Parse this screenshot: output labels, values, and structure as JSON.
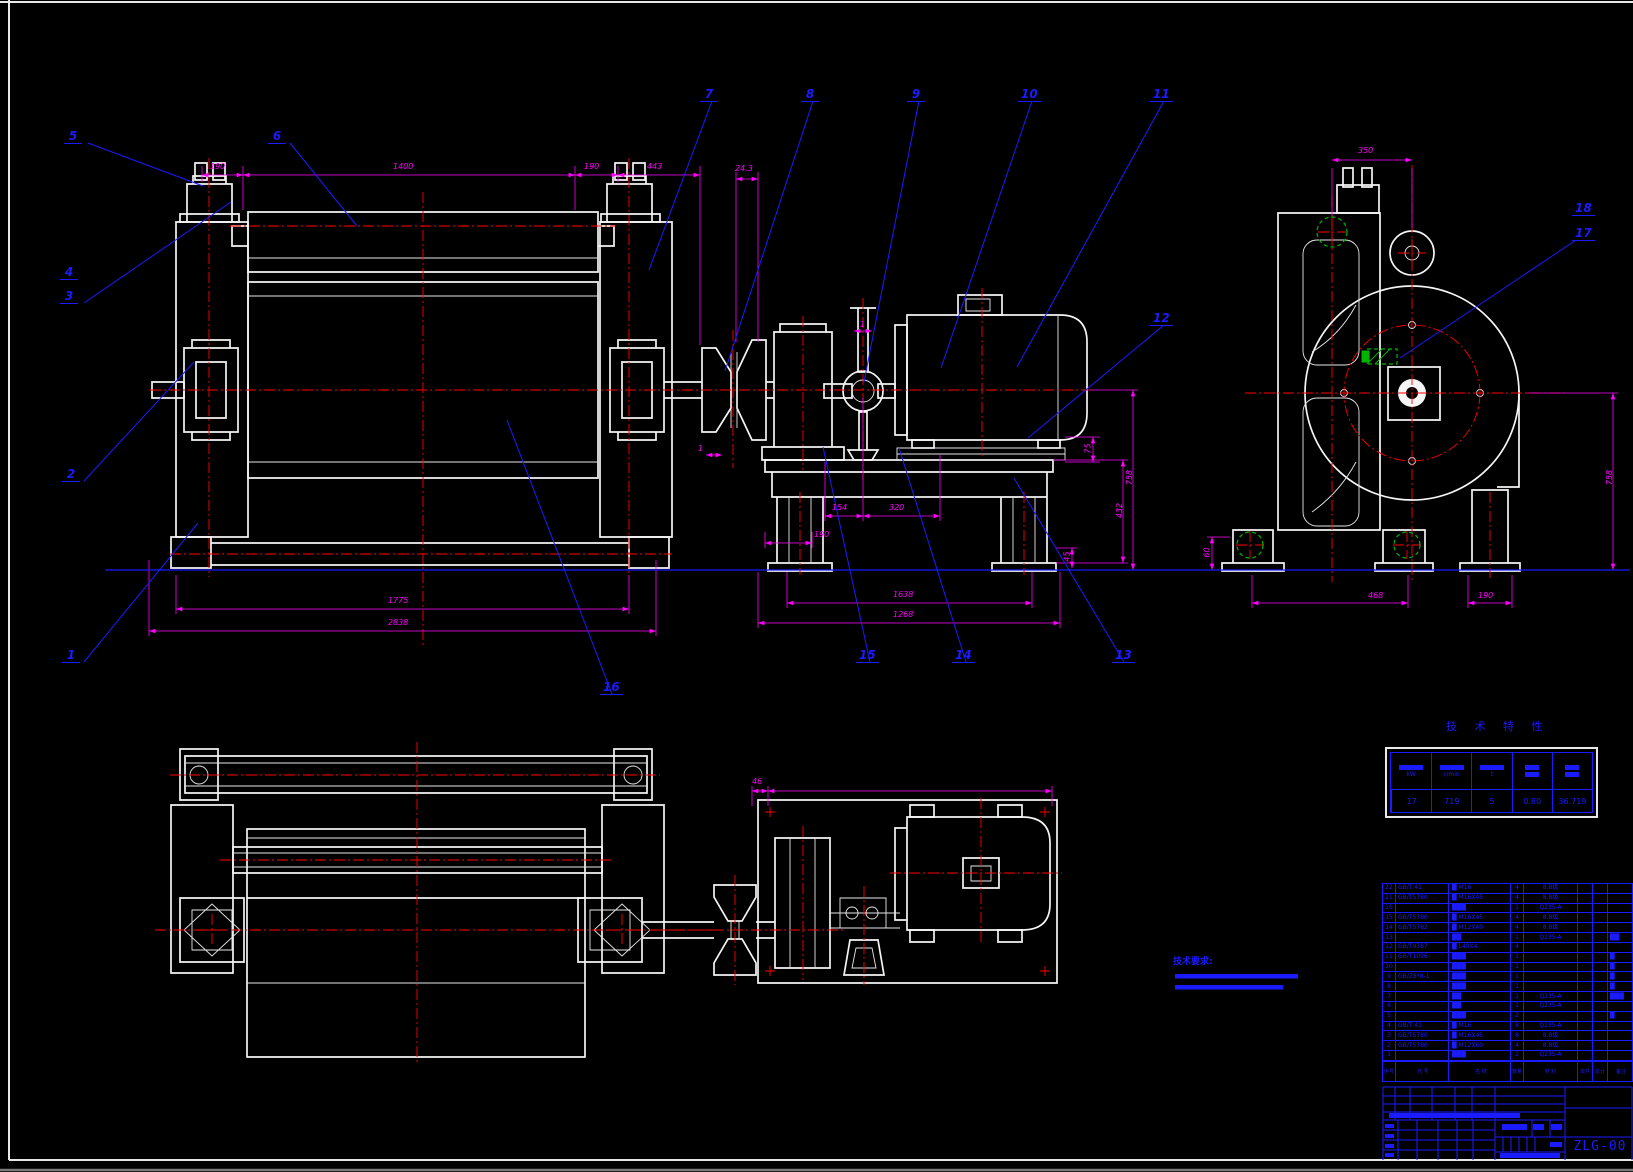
{
  "sheet": {
    "drawing_no": "ZLG-00"
  },
  "tech_note": {
    "label": "技术要求:"
  },
  "tech_table": {
    "title": "技 术 特 性",
    "units": [
      "kW",
      "r/min",
      "t",
      "",
      ""
    ],
    "values": [
      "17",
      "719",
      "5",
      "0.80",
      "36.719"
    ]
  },
  "balloons": {
    "b1": "1",
    "b2": "2",
    "b3": "3",
    "b4": "4",
    "b5": "5",
    "b6": "6",
    "b7": "7",
    "b8": "8",
    "b9": "9",
    "b10": "10",
    "b11": "11",
    "b12": "12",
    "b13": "13",
    "b14": "14",
    "b15": "15",
    "b16": "16",
    "b17": "17",
    "b18": "18"
  },
  "dims": {
    "ft1": "190",
    "ft2": "1400",
    "ft3": "190",
    "ft4": "443",
    "ft5": "24.3",
    "fb1": "1775",
    "fb2": "2838",
    "m154": "154",
    "m320": "320",
    "m190": "190",
    "m1638": "1638",
    "m1268": "1268",
    "mr75": "75",
    "mr432": "432",
    "mr45": "45",
    "mr758": "758",
    "r350": "350",
    "r60": "60",
    "r468": "468",
    "r190": "190",
    "r758": "758",
    "pd46": "46",
    "pd1288": "1288",
    "one_a": "1",
    "one_b": "1"
  },
  "bom": {
    "header": {
      "no": "序号",
      "code": "代 号",
      "name": "名 称",
      "qty": "数量",
      "material": "材 料",
      "unit": "单件",
      "total": "总计",
      "remark": "备注"
    },
    "rows": [
      {
        "no": "22",
        "code": "GB/T 41",
        "name": "█ M16",
        "qty": "4",
        "mat": "8.8级",
        "rem": ""
      },
      {
        "no": "21",
        "code": "GB/T5780",
        "name": "█ M16X45",
        "qty": "4",
        "mat": "8.8级",
        "rem": ""
      },
      {
        "no": "16",
        "code": "",
        "name": "███",
        "qty": "1",
        "mat": "Q235-A",
        "rem": ""
      },
      {
        "no": "15",
        "code": "GB/T5780",
        "name": "█ M16X45",
        "qty": "4",
        "mat": "8.8级",
        "rem": ""
      },
      {
        "no": "14",
        "code": "GB/T5782",
        "name": "█ M12X40",
        "qty": "4",
        "mat": "8.8级",
        "rem": ""
      },
      {
        "no": "13",
        "code": "",
        "name": "██",
        "qty": "1",
        "mat": "Q235-A",
        "rem": "██"
      },
      {
        "no": "12",
        "code": "GB/T9787",
        "name": "█ L40X4",
        "qty": "4",
        "mat": "",
        "rem": ""
      },
      {
        "no": "11",
        "code": "GB/T1096",
        "name": "███",
        "qty": "1",
        "mat": "",
        "rem": "█"
      },
      {
        "no": "10",
        "code": "",
        "name": "███",
        "qty": "1",
        "mat": "",
        "rem": "█"
      },
      {
        "no": "9",
        "code": "GB/Z8*8-1",
        "name": "███",
        "qty": "1",
        "mat": "",
        "rem": "█"
      },
      {
        "no": "8",
        "code": "",
        "name": "███",
        "qty": "1",
        "mat": "",
        "rem": "█"
      },
      {
        "no": "7",
        "code": "",
        "name": "██",
        "qty": "1",
        "mat": "Q235-A",
        "rem": "███"
      },
      {
        "no": "6",
        "code": "",
        "name": "██",
        "qty": "1",
        "mat": "Q235-A",
        "rem": ""
      },
      {
        "no": "5",
        "code": "",
        "name": "███",
        "qty": "2",
        "mat": "",
        "rem": "█"
      },
      {
        "no": "4",
        "code": "GB/T 41",
        "name": "█ M16",
        "qty": "8",
        "mat": "Q235-A",
        "rem": ""
      },
      {
        "no": "3",
        "code": "GB/T5780",
        "name": "█ M16X45",
        "qty": "8",
        "mat": "8.8级",
        "rem": ""
      },
      {
        "no": "2",
        "code": "GB/T5780",
        "name": "█ M12X60",
        "qty": "4",
        "mat": "8.8级",
        "rem": ""
      },
      {
        "no": "1",
        "code": "",
        "name": "███",
        "qty": "2",
        "mat": "Q235-A",
        "rem": ""
      }
    ]
  }
}
